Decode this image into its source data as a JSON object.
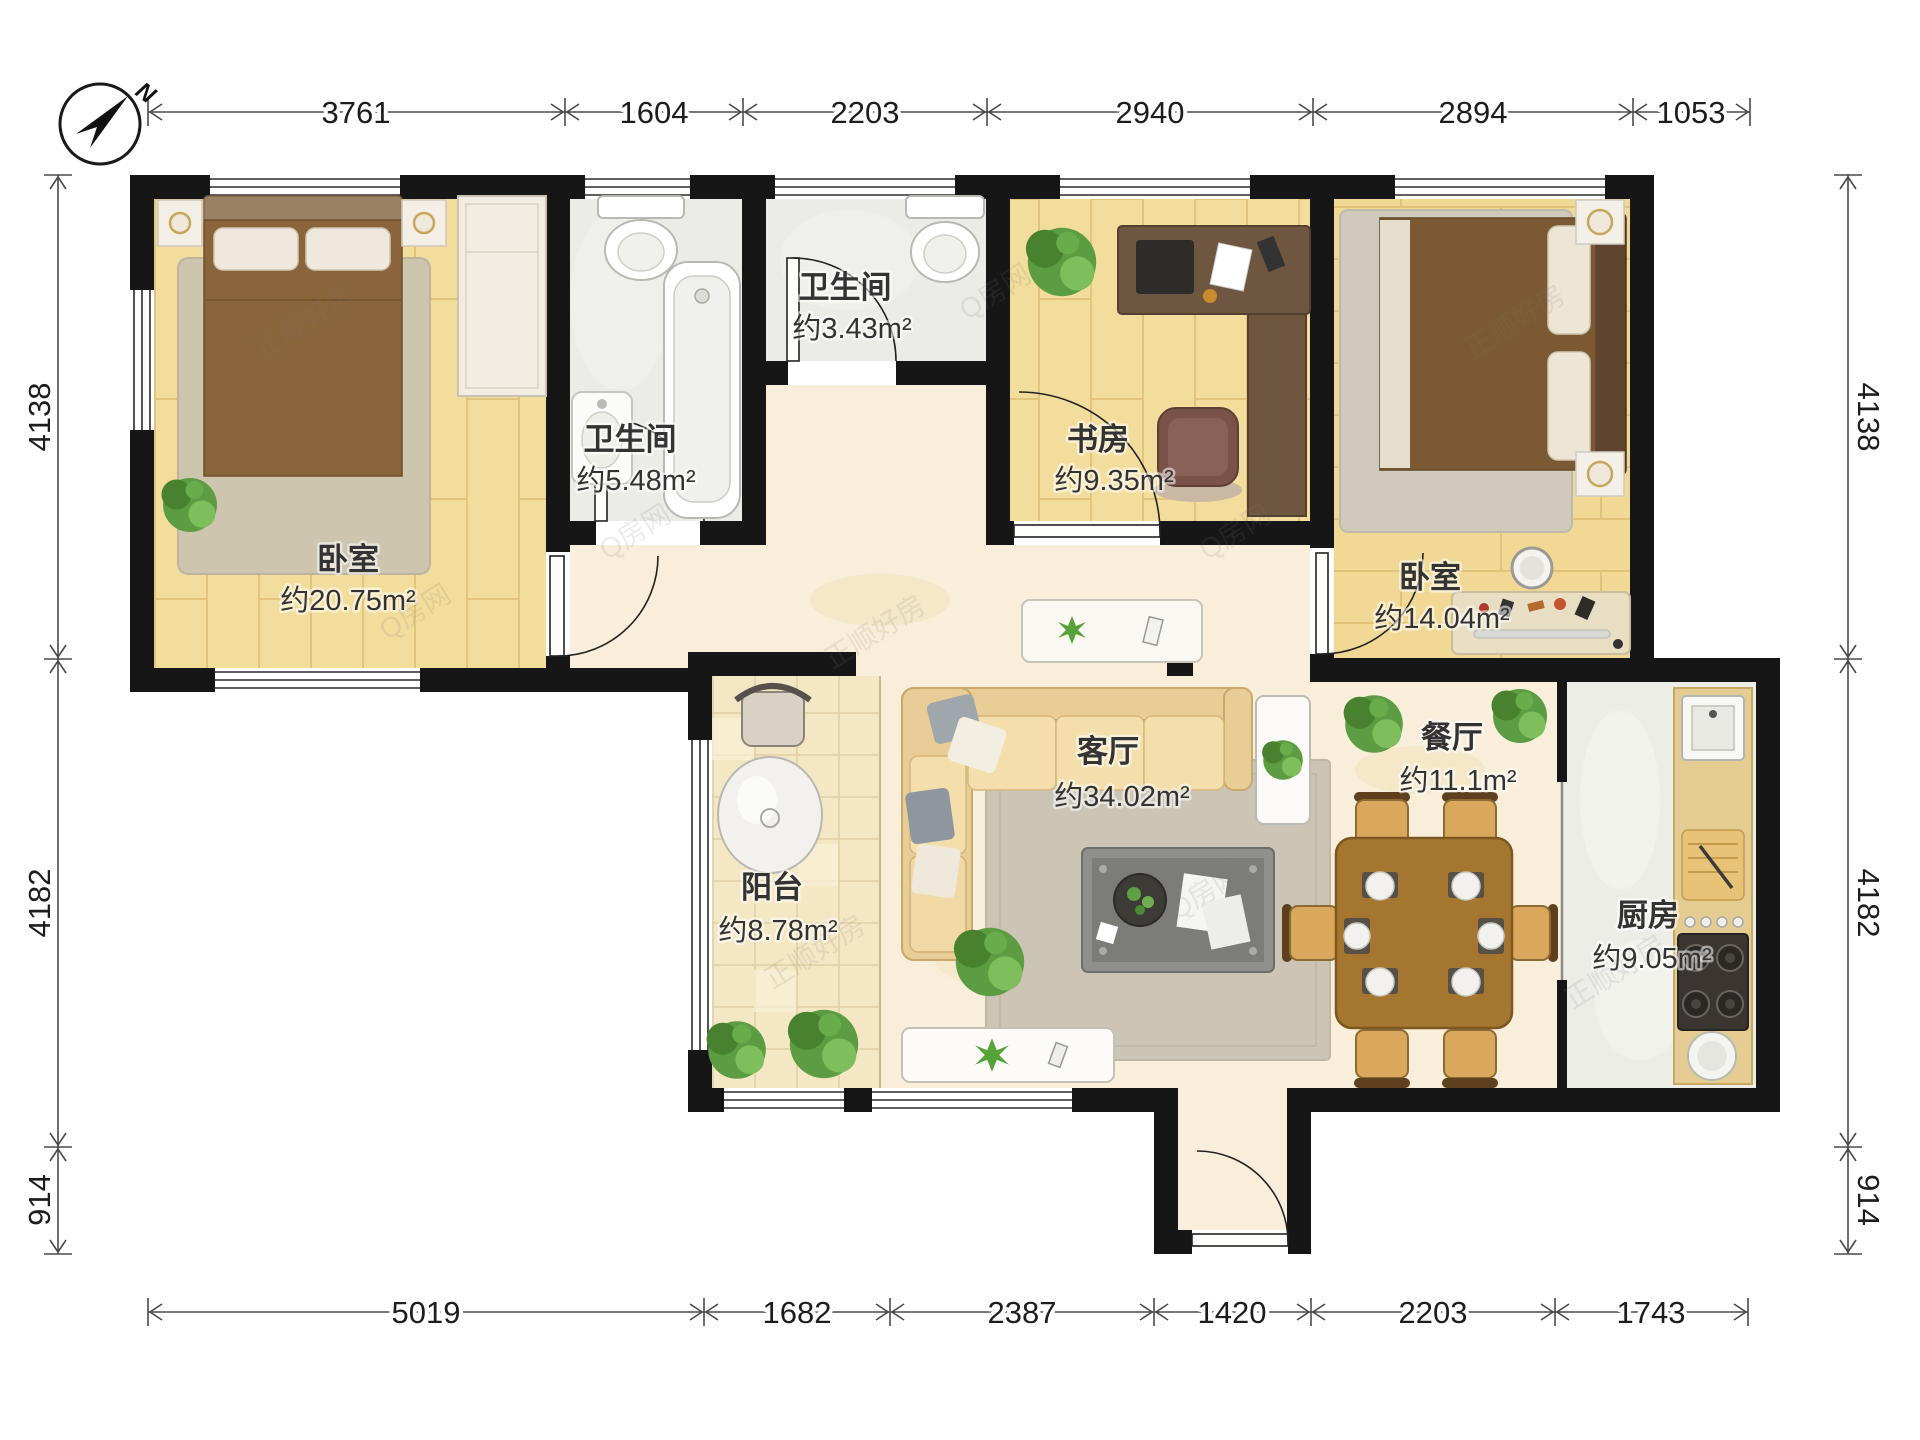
{
  "compass": {
    "north_label": "N"
  },
  "rooms": {
    "bedroom_left": {
      "name": "卧室",
      "area": "约20.75m²"
    },
    "bathroom_main": {
      "name": "卫生间",
      "area": "约5.48m²"
    },
    "bathroom_small": {
      "name": "卫生间",
      "area": "约3.43m²"
    },
    "study": {
      "name": "书房",
      "area": "约9.35m²"
    },
    "bedroom_right": {
      "name": "卧室",
      "area": "约14.04m²"
    },
    "living_room": {
      "name": "客厅",
      "area": "约34.02m²"
    },
    "balcony": {
      "name": "阳台",
      "area": "约8.78m²"
    },
    "dining_room": {
      "name": "餐厅",
      "area": "约11.1m²"
    },
    "kitchen": {
      "name": "厨房",
      "area": "约9.05m²"
    }
  },
  "dimensions_mm": {
    "top": [
      "3761",
      "1604",
      "2203",
      "2940",
      "2894",
      "1053"
    ],
    "bottom": [
      "5019",
      "1682",
      "2387",
      "1420",
      "2203",
      "1743"
    ],
    "left": [
      "4138",
      "4182",
      "914"
    ],
    "right": [
      "4138",
      "4182",
      "914"
    ]
  },
  "watermarks": {
    "brand": "正顺好房",
    "site": "Q房网"
  },
  "colors": {
    "wall": "#161616",
    "wood_floor": "#F3DD9D",
    "marble_floor": "#F8EED9",
    "balcony_tile": "#F4E7C4",
    "bath_floor": "#EBEBE7",
    "kitchen_floor": "#EDEDE8"
  }
}
